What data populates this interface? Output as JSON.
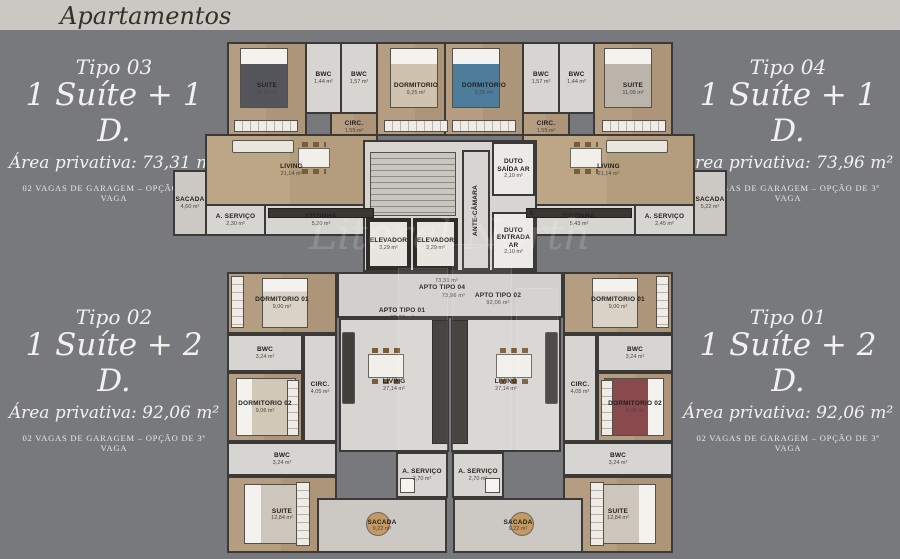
{
  "header": {
    "title": "Apartamentos"
  },
  "watermark": {
    "text": "Litoral North"
  },
  "palette": {
    "background": "#77797c",
    "band": "#cbc8c3",
    "wall": "#3c3a38",
    "wood_floor": "#b59d81",
    "tile_floor": "#d7d5d1",
    "text_light": "#f2f1ef"
  },
  "types": {
    "tipo03": {
      "name": "Tipo 03",
      "config": "1 Suíte + 1 D.",
      "area": "Área privativa: 73,31 m²",
      "garage": "02 VAGAS DE GARAGEM  –  OPÇÃO DE 3ª VAGA"
    },
    "tipo04": {
      "name": "Tipo 04",
      "config": "1 Suíte + 1 D.",
      "area": "Área privativa: 73,96 m²",
      "garage": "02 VAGAS DE GARAGEM  –  OPÇÃO DE 3ª VAGA"
    },
    "tipo02": {
      "name": "Tipo 02",
      "config": "1 Suíte + 2 D.",
      "area": "Área privativa: 92,06 m²",
      "garage": "02 VAGAS DE GARAGEM  –  OPÇÃO DE 3ª VAGA"
    },
    "tipo01": {
      "name": "Tipo 01",
      "config": "1 Suíte + 2 D.",
      "area": "Área privativa: 92,06 m²",
      "garage": "02 VAGAS DE GARAGEM  –  OPÇÃO DE 3ª VAGA"
    }
  },
  "plan": {
    "core": {
      "escada": "ESCADA",
      "elevador": {
        "label": "ELEVADOR",
        "area": "3,29 m²"
      },
      "duto_saida": {
        "label": "DUTO SAÍDA AR",
        "area": "2,10 m²"
      },
      "duto_entrada": {
        "label": "DUTO ENTRADA AR",
        "area": "2,10 m²"
      },
      "antecamara": "ANTE-CÂMARA"
    },
    "corridor": {
      "apto03": {
        "label": "APTO TIPO 03",
        "area": "73,31 m²"
      },
      "apto02": {
        "label": "APTO TIPO 02",
        "area": "92,06 m²"
      },
      "apto01": {
        "label": "APTO TIPO 01",
        "area": "92,06 m²"
      },
      "apto04": {
        "label": "APTO TIPO 04",
        "area": "73,96 m²"
      }
    },
    "units": {
      "tipo03": {
        "rooms": {
          "suite": {
            "label": "SUITE",
            "area": "11,09 m²"
          },
          "bwc1": {
            "label": "BWC",
            "area": "1,44 m²"
          },
          "bwc2": {
            "label": "BWC",
            "area": "1,57 m²"
          },
          "dorm": {
            "label": "DORMITORIO",
            "area": "9,25 m²"
          },
          "circ": {
            "label": "CIRC.",
            "area": "1,55 m²"
          },
          "living": {
            "label": "LIVING",
            "area": "21,14 m²"
          },
          "servico": {
            "label": "A. SERVIÇO",
            "area": "2,30 m²"
          },
          "cozinha": {
            "label": "COZINHA",
            "area": "5,20 m²"
          },
          "sacada": {
            "label": "SACADA",
            "area": "4,60 m²"
          }
        }
      },
      "tipo04": {
        "rooms": {
          "dorm": {
            "label": "DORMITORIO",
            "area": "9,25 m²"
          },
          "bwc1": {
            "label": "BWC",
            "area": "1,57 m²"
          },
          "bwc2": {
            "label": "BWC",
            "area": "1,44 m²"
          },
          "suite": {
            "label": "SUITE",
            "area": "11,09 m²"
          },
          "circ": {
            "label": "CIRC.",
            "area": "1,55 m²"
          },
          "living": {
            "label": "LIVING",
            "area": "21,14 m²"
          },
          "cozinha": {
            "label": "COZINHA",
            "area": "5,43 m²"
          },
          "servico": {
            "label": "A. SERVIÇO",
            "area": "2,45 m²"
          },
          "sacada": {
            "label": "SACADA",
            "area": "5,22 m²"
          }
        }
      },
      "tipo02": {
        "rooms": {
          "dorm1": {
            "label": "DORMITORIO 01",
            "area": "9,00 m²"
          },
          "bwc_social": {
            "label": "BWC",
            "area": "3,24 m²"
          },
          "circ": {
            "label": "CIRC.",
            "area": "4,05 m²"
          },
          "dorm2": {
            "label": "DORMITORIO 02",
            "area": "9,06 m²"
          },
          "bwc_suite": {
            "label": "BWC",
            "area": "3,24 m²"
          },
          "suite": {
            "label": "SUITE",
            "area": "12,84 m²"
          },
          "living": {
            "label": "LIVING",
            "area": "27,14 m²"
          },
          "servico": {
            "label": "A. SERVIÇO",
            "area": "2,70 m²"
          },
          "sacada": {
            "label": "SACADA",
            "area": "9,22 m²"
          }
        }
      },
      "tipo01": {
        "rooms": {
          "dorm1": {
            "label": "DORMITORIO 01",
            "area": "9,00 m²"
          },
          "bwc_social": {
            "label": "BWC",
            "area": "3,24 m²"
          },
          "circ": {
            "label": "CIRC.",
            "area": "4,05 m²"
          },
          "dorm2": {
            "label": "DORMITORIO 02",
            "area": "9,06 m²"
          },
          "bwc_suite": {
            "label": "BWC",
            "area": "3,24 m²"
          },
          "suite": {
            "label": "SUITE",
            "area": "12,84 m²"
          },
          "living": {
            "label": "LIVING",
            "area": "27,14 m²"
          },
          "servico": {
            "label": "A. SERVIÇO",
            "area": "2,70 m²"
          },
          "sacada": {
            "label": "SACADA",
            "area": "9,22 m²"
          }
        }
      }
    }
  }
}
